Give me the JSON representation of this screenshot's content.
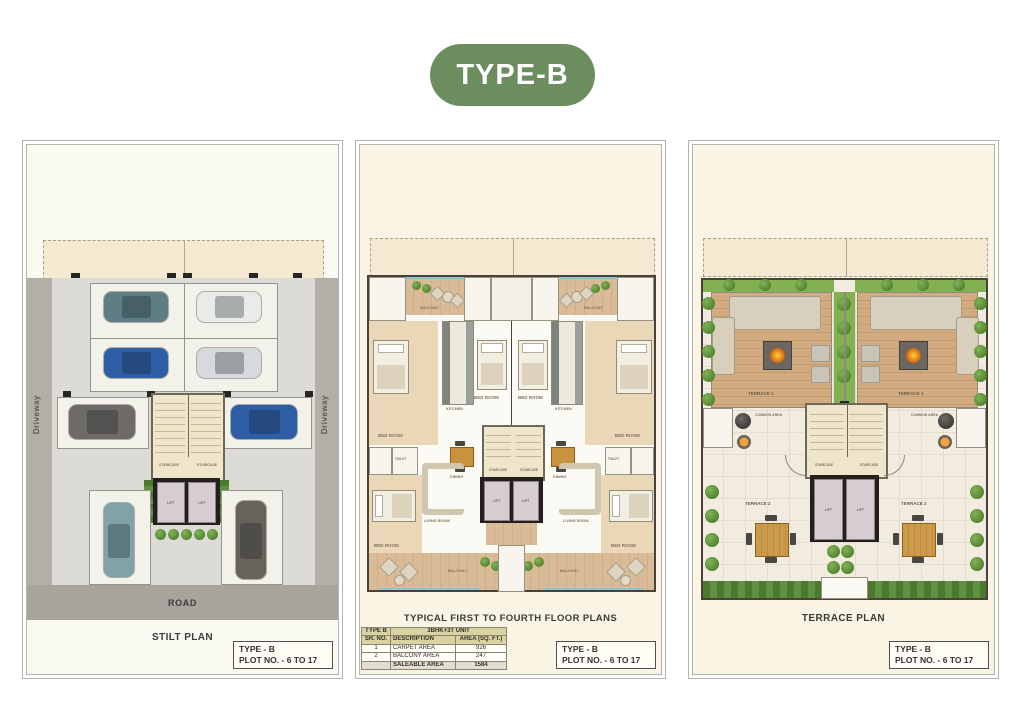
{
  "badge": {
    "label": "TYPE-B"
  },
  "colors": {
    "badge-green": "#6c8d5e",
    "panel-border": "#b3b3b0"
  },
  "titleblock": {
    "line1": "TYPE - B",
    "line2": "PLOT NO. - 6 TO 17"
  },
  "stilt": {
    "caption": "STILT PLAN",
    "road": "ROAD",
    "driveway": "Driveway",
    "staircase": "STAIRCASE",
    "lift": "LIFT"
  },
  "floor": {
    "caption": "TYPICAL FIRST TO FOURTH FLOOR PLANS",
    "labels": {
      "balcony": "BALCONY",
      "bedroom": "BED ROOM",
      "kitchen": "KITCHEN",
      "dining": "DINING",
      "living": "LIVING ROOM",
      "toilet": "TOILET",
      "staircase": "STAIRCASE",
      "lift": "LIFT"
    },
    "table": {
      "type": "TYPE B",
      "unit": "3BHK+3T UNIT",
      "col_sr": "SR. NO.",
      "col_desc": "DESCRIPTION",
      "col_area": "AREA (SQ. FT.)",
      "rows": [
        {
          "sr": "1",
          "desc": "CARPET AREA",
          "area": "926"
        },
        {
          "sr": "2",
          "desc": "BALCONY AREA",
          "area": "247"
        }
      ],
      "total_label": "SALEABLE AREA",
      "total_value": "1584"
    }
  },
  "terrace": {
    "caption": "TERRACE PLAN",
    "terrace1": "TERRACE 1",
    "terrace2": "TERRACE 2",
    "common": "COMMON AREA",
    "staircase": "STAIRCASE",
    "lift": "LIFT"
  }
}
